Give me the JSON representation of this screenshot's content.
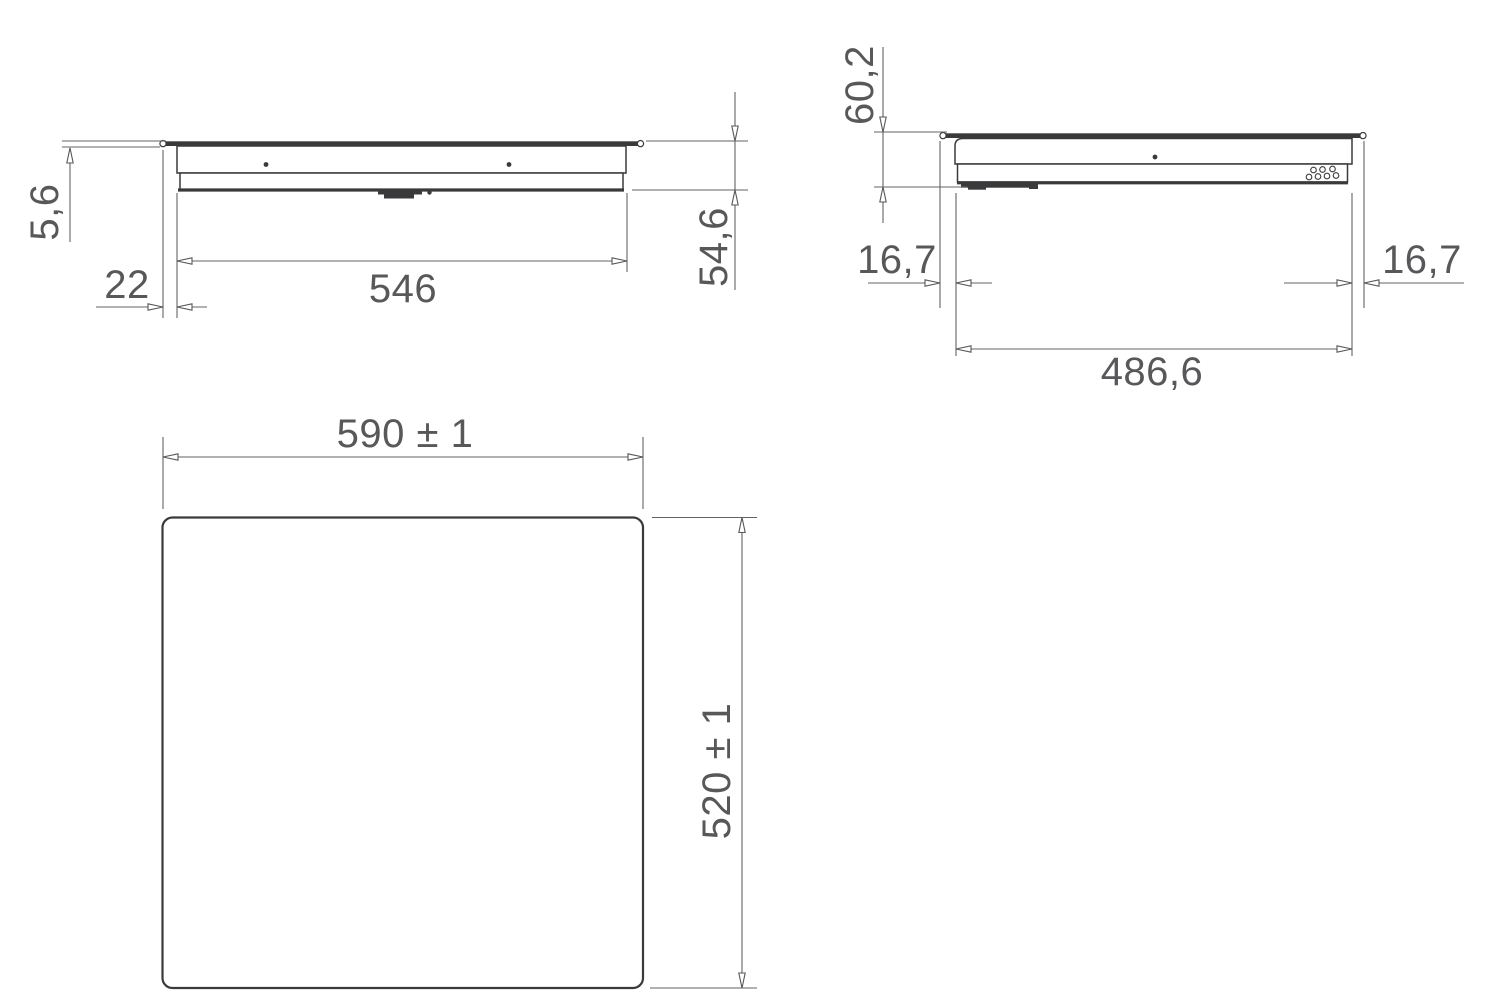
{
  "colors": {
    "outline": "#3a3a3c",
    "dimension": "#58585a",
    "background": "#ffffff"
  },
  "views": {
    "front": {
      "dims": {
        "glass_thickness": "5,6",
        "glass_overhang": "22",
        "body_width": "546",
        "build_in_height": "54,6"
      }
    },
    "side": {
      "dims": {
        "total_height": "60,2",
        "overhang_left": "16,7",
        "overhang_right": "16,7",
        "body_depth": "486,6"
      }
    },
    "top": {
      "dims": {
        "width": "590 ± 1",
        "depth": "520 ± 1"
      }
    }
  }
}
